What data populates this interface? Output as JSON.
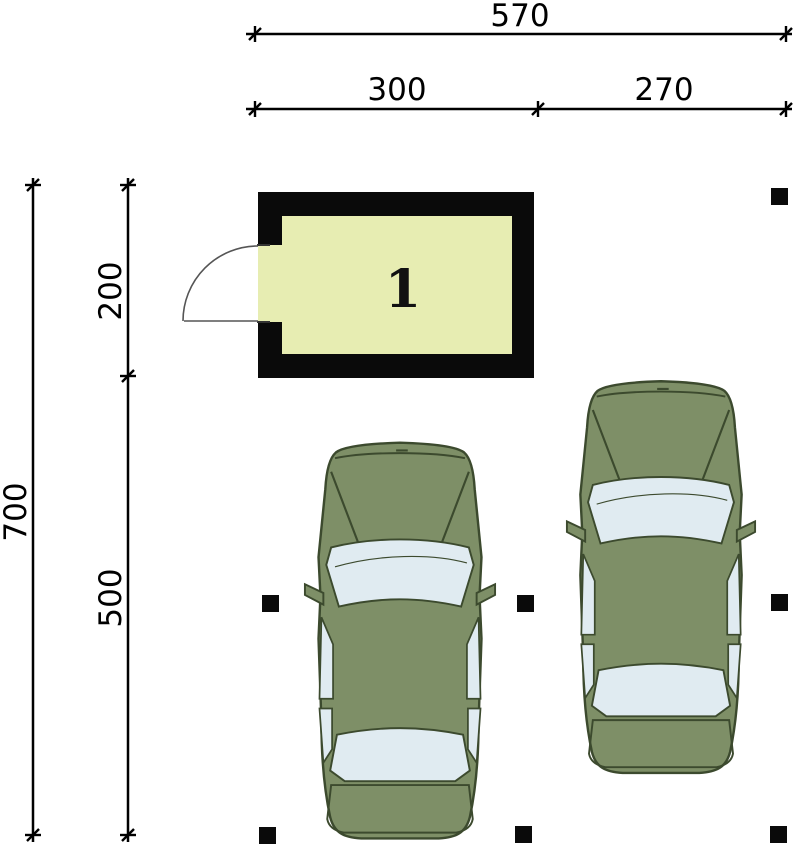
{
  "dimensions": {
    "top_total": "570",
    "top_segment_left": "300",
    "top_segment_right": "270",
    "left_total": "700",
    "left_segment_upper": "200",
    "left_segment_lower": "500"
  },
  "room": {
    "label": "1"
  },
  "objects": {
    "car_count": 2,
    "post_count": 7
  },
  "colors": {
    "background": "#ffffff",
    "line": "#000000",
    "wall": "#0a0a0a",
    "room_fill": "#e7edb2",
    "car_body": "#7e8f67",
    "car_outline": "#3c4a2e",
    "car_glass": "#e0ebf1",
    "door_line": "#555555"
  }
}
